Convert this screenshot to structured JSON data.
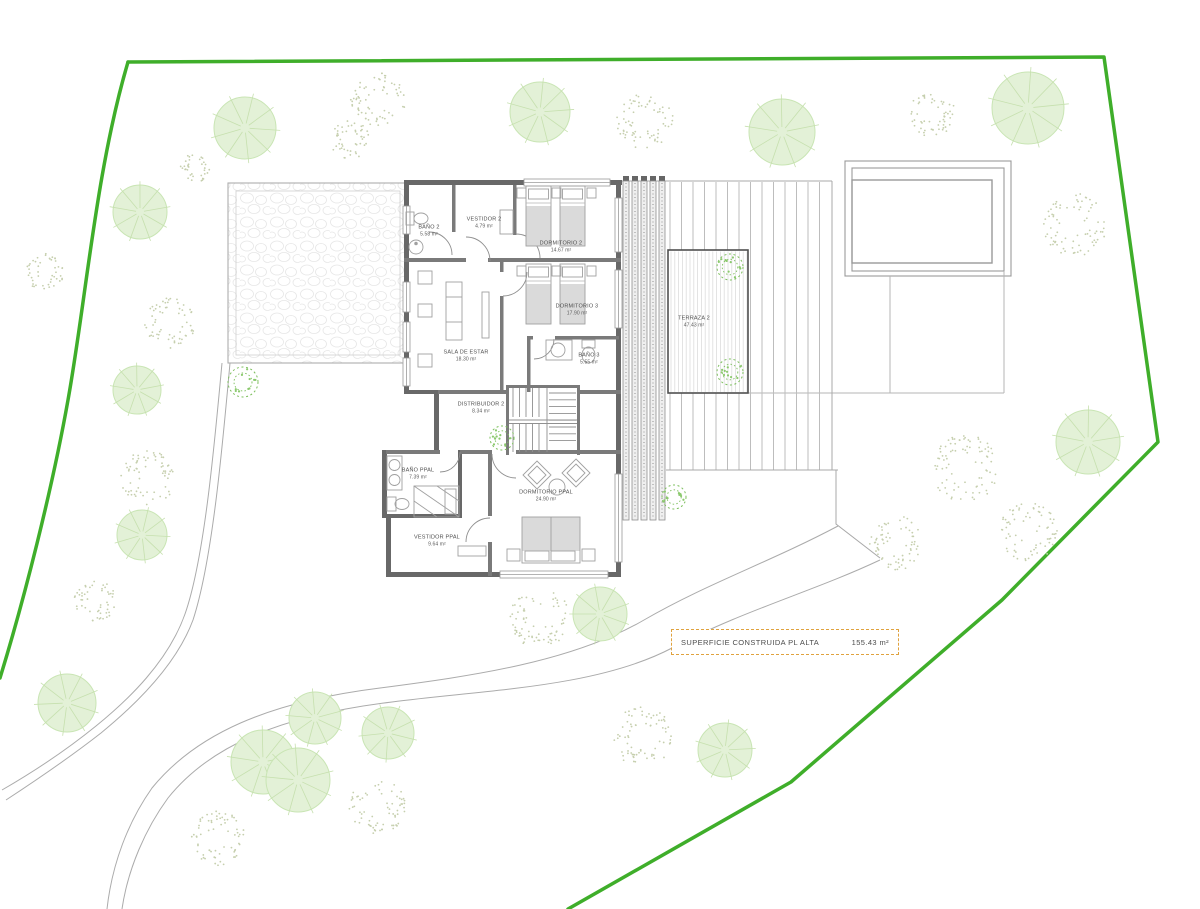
{
  "rooms": [
    {
      "name": "BAÑO 2",
      "area": "5.58 m²"
    },
    {
      "name": "VESTIDOR 2",
      "area": "4.79 m²"
    },
    {
      "name": "DORMITORIO 2",
      "area": "14.67 m²"
    },
    {
      "name": "DORMITORIO 3",
      "area": "17.90 m²"
    },
    {
      "name": "BAÑO 3",
      "area": "5.55 m²"
    },
    {
      "name": "SALA DE ESTAR",
      "area": "18.30 m²"
    },
    {
      "name": "DISTRIBUIDOR 2",
      "area": "8.34 m²"
    },
    {
      "name": "BAÑO PPAL",
      "area": "7.39 m²"
    },
    {
      "name": "DORMITORIO PPAL",
      "area": "24.90 m²"
    },
    {
      "name": "VESTIDOR PPAL",
      "area": "9.64 m²"
    },
    {
      "name": "TERRAZA 2",
      "area": "47.43 m²"
    }
  ],
  "summary": {
    "label": "SUPERFICIE CONSTRUIDA PL ALTA",
    "value": "155.43 m²"
  },
  "colors": {
    "boundary": "#3fae2a",
    "accent": "#e0a23e",
    "wall": "#686868",
    "wall_int": "#7a7a7a",
    "line": "#9a9a9a",
    "light_line": "#b5b5b5",
    "plank": "#bdbdbd",
    "tree_fill": "#e3f1d7",
    "tree_stroke": "#c9e5b4",
    "spoke": "#c6e0ae",
    "stipple": "#c6cfae",
    "shrub": "#7cbf5c",
    "shrub_dot": "#8bc96d"
  },
  "site": {
    "trees": [
      {
        "type": "canopy",
        "x": 245,
        "y": 128,
        "r": 31
      },
      {
        "type": "canopy",
        "x": 540,
        "y": 112,
        "r": 30
      },
      {
        "type": "canopy",
        "x": 782,
        "y": 132,
        "r": 33
      },
      {
        "type": "canopy",
        "x": 1028,
        "y": 108,
        "r": 36
      },
      {
        "type": "canopy",
        "x": 140,
        "y": 212,
        "r": 27
      },
      {
        "type": "canopy",
        "x": 137,
        "y": 390,
        "r": 24
      },
      {
        "type": "canopy",
        "x": 142,
        "y": 535,
        "r": 25
      },
      {
        "type": "canopy",
        "x": 67,
        "y": 703,
        "r": 29
      },
      {
        "type": "canopy",
        "x": 263,
        "y": 762,
        "r": 32
      },
      {
        "type": "canopy",
        "x": 298,
        "y": 780,
        "r": 32
      },
      {
        "type": "canopy",
        "x": 315,
        "y": 718,
        "r": 26
      },
      {
        "type": "canopy",
        "x": 388,
        "y": 733,
        "r": 26
      },
      {
        "type": "canopy",
        "x": 600,
        "y": 614,
        "r": 27
      },
      {
        "type": "canopy",
        "x": 725,
        "y": 750,
        "r": 27
      },
      {
        "type": "canopy",
        "x": 1088,
        "y": 442,
        "r": 32
      },
      {
        "type": "stipple",
        "x": 378,
        "y": 100,
        "r": 26
      },
      {
        "type": "stipple",
        "x": 350,
        "y": 140,
        "r": 19
      },
      {
        "type": "stipple",
        "x": 195,
        "y": 168,
        "r": 14
      },
      {
        "type": "stipple",
        "x": 645,
        "y": 122,
        "r": 27
      },
      {
        "type": "stipple",
        "x": 932,
        "y": 114,
        "r": 22
      },
      {
        "type": "stipple",
        "x": 1075,
        "y": 225,
        "r": 30
      },
      {
        "type": "stipple",
        "x": 45,
        "y": 272,
        "r": 18
      },
      {
        "type": "stipple",
        "x": 170,
        "y": 323,
        "r": 24
      },
      {
        "type": "stipple",
        "x": 148,
        "y": 478,
        "r": 26
      },
      {
        "type": "stipple",
        "x": 95,
        "y": 601,
        "r": 20
      },
      {
        "type": "stipple",
        "x": 540,
        "y": 618,
        "r": 29
      },
      {
        "type": "stipple",
        "x": 643,
        "y": 737,
        "r": 29
      },
      {
        "type": "stipple",
        "x": 218,
        "y": 838,
        "r": 26
      },
      {
        "type": "stipple",
        "x": 377,
        "y": 806,
        "r": 27
      },
      {
        "type": "stipple",
        "x": 965,
        "y": 468,
        "r": 33
      },
      {
        "type": "stipple",
        "x": 897,
        "y": 543,
        "r": 26
      },
      {
        "type": "stipple",
        "x": 1028,
        "y": 532,
        "r": 28
      },
      {
        "type": "shrub",
        "x": 243,
        "y": 382,
        "r": 15
      },
      {
        "type": "shrub",
        "x": 502,
        "y": 438,
        "r": 12
      },
      {
        "type": "shrub",
        "x": 730,
        "y": 267,
        "r": 13
      },
      {
        "type": "shrub",
        "x": 730,
        "y": 372,
        "r": 13
      },
      {
        "type": "shrub",
        "x": 674,
        "y": 497,
        "r": 12
      }
    ]
  }
}
